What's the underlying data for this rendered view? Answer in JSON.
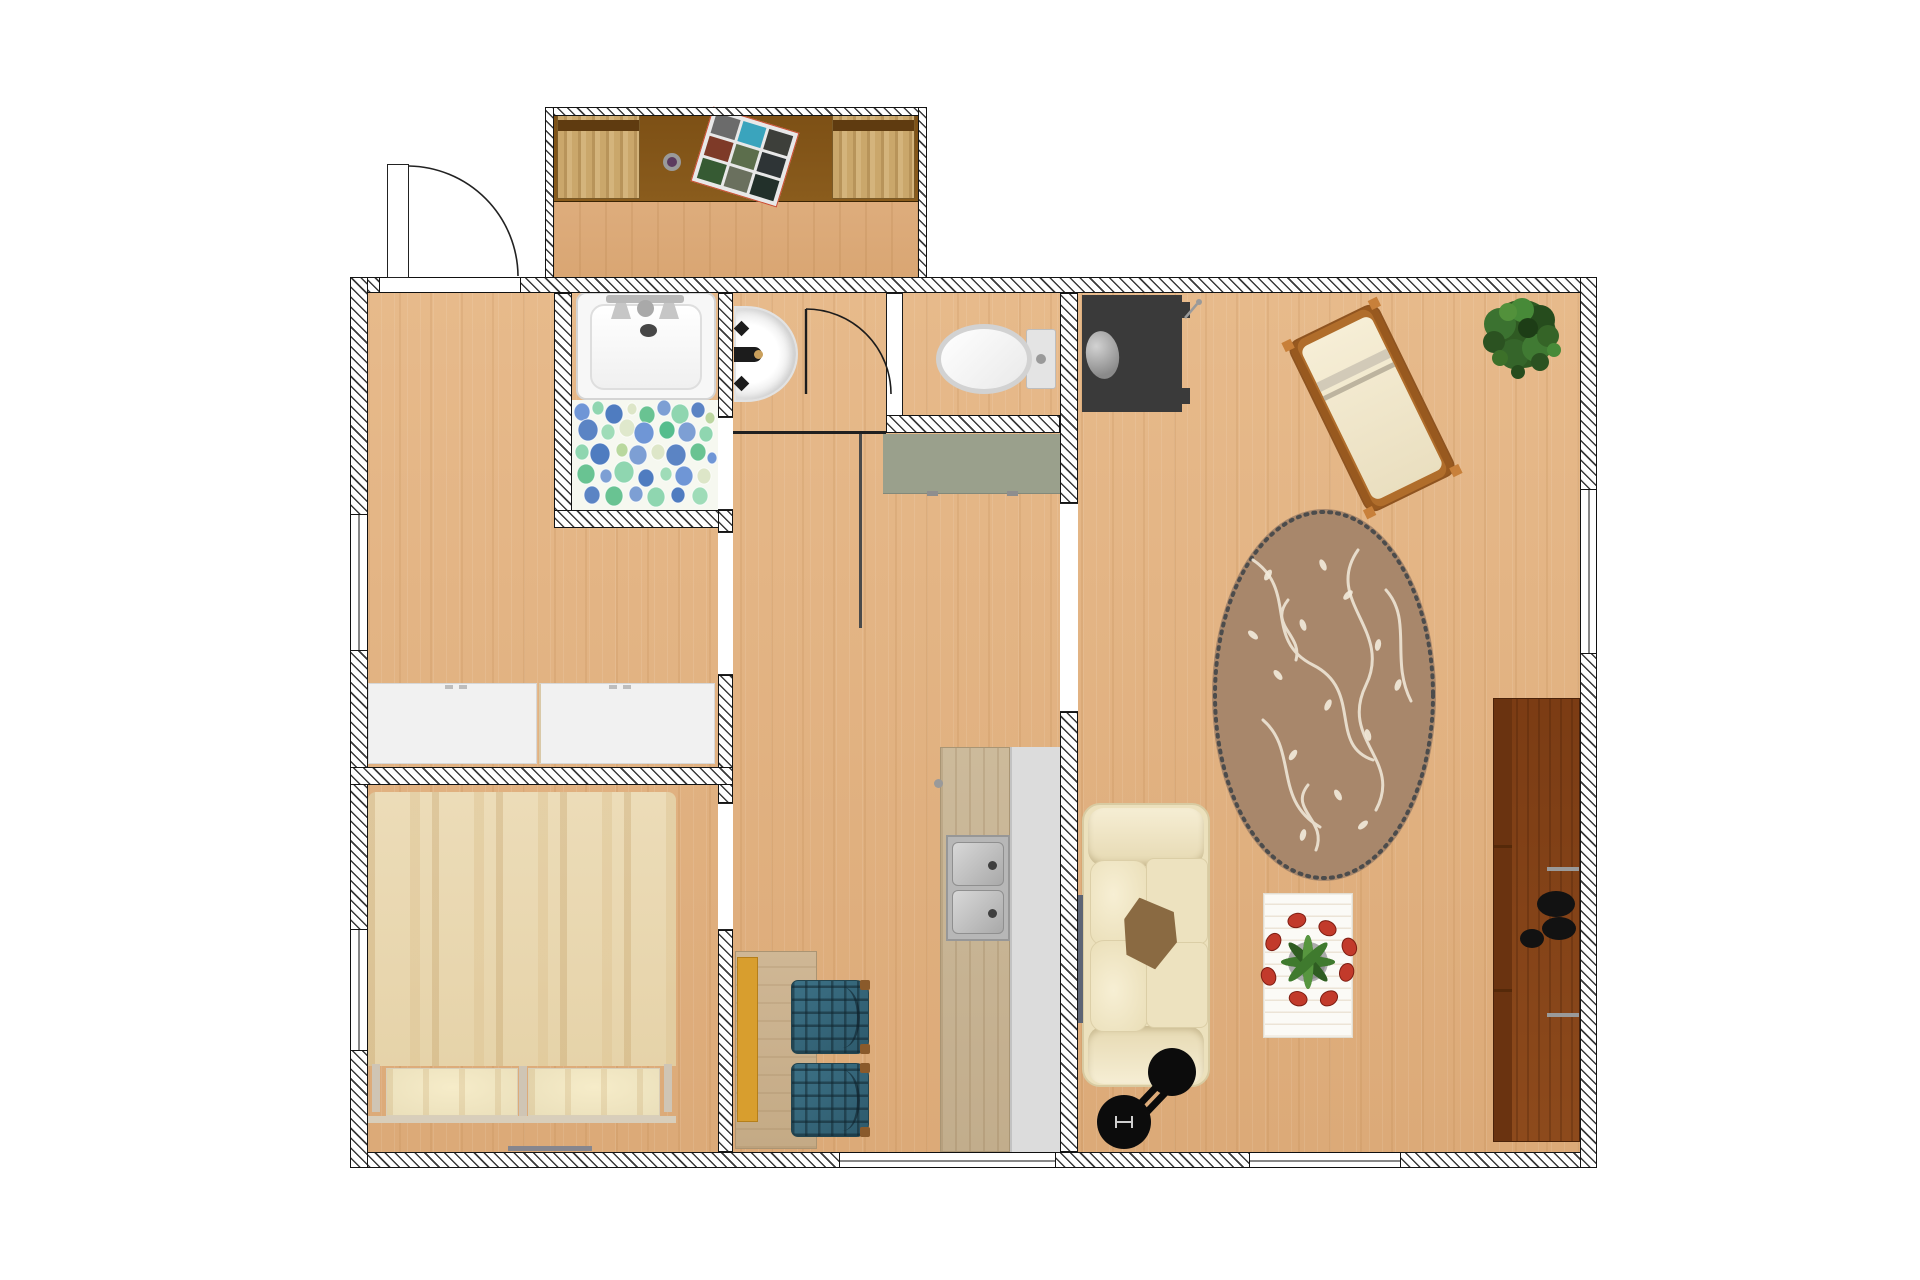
{
  "app": {
    "type": "floor-plan-render",
    "background": "#ffffff",
    "canvas_w": 1920,
    "canvas_h": 1280
  },
  "palette": {
    "floor_wood": "#e4b283",
    "wall_hatch": "#3a3a3a",
    "wall_outline": "#141414",
    "mosaic_bg": "#f6f8f0",
    "mosaic_blue": "#5b84c4",
    "mosaic_green": "#69c392",
    "rug_base": "#a8876b",
    "rug_pattern": "#f3ebdc",
    "rug_border": "#4c4c4c",
    "sofa_cream": "#ece1bd",
    "chair_plaid": "#2e5a6c",
    "bench_yellow": "#d89e2e",
    "counter_gray_green": "#9aa08c",
    "counter_white": "#dcdcdc",
    "counter_wood": "#c9b697",
    "tv_dark": "#3a3a3a",
    "sideboard_brown": "#7b3c14",
    "chaise_frame": "#b06d2b",
    "plant_green": "#2f5a23",
    "tulip_red": "#c23a2b",
    "bed_duvet": "#ead9b4",
    "desk_brown": "#7d5015",
    "fixture_white": "#f7f7f7"
  },
  "rooms": [
    {
      "id": "balcony",
      "label": "balcony",
      "rect": [
        545,
        107,
        382,
        186
      ]
    },
    {
      "id": "hallway",
      "label": "hallway-closet-room",
      "rect": [
        368,
        293,
        350,
        474
      ]
    },
    {
      "id": "bathroom",
      "label": "bathroom",
      "rect": [
        572,
        293,
        146,
        217
      ]
    },
    {
      "id": "washroom",
      "label": "washbasin-room",
      "rect": [
        733,
        293,
        153,
        138
      ]
    },
    {
      "id": "wc",
      "label": "toilet-room",
      "rect": [
        903,
        293,
        157,
        122
      ]
    },
    {
      "id": "bedroom",
      "label": "bedroom",
      "rect": [
        368,
        785,
        350,
        367
      ]
    },
    {
      "id": "kitchen",
      "label": "kitchen-dining",
      "rect": [
        733,
        433,
        327,
        719
      ]
    },
    {
      "id": "living",
      "label": "living-room",
      "rect": [
        1078,
        293,
        502,
        859
      ]
    }
  ],
  "openings": {
    "entry_door": {
      "rect": [
        380,
        277,
        140,
        16
      ],
      "swing": "out-north",
      "hinge": "left"
    },
    "washroom_door": {
      "leaf_x": 806,
      "leaf_y1": 309,
      "leaf_y2": 394,
      "arc_end": [
        891,
        389
      ]
    },
    "doorway_bath": {
      "rect": [
        718,
        417,
        15,
        93
      ]
    },
    "doorway_hall_kitchen": {
      "rect": [
        718,
        532,
        15,
        143
      ]
    },
    "doorway_bedroom": {
      "rect": [
        718,
        803,
        15,
        127
      ]
    },
    "doorway_living": {
      "rect": [
        1060,
        503,
        18,
        209
      ]
    },
    "window_left_upper": {
      "rect": [
        350,
        515,
        18,
        135
      ]
    },
    "window_left_lower": {
      "rect": [
        350,
        930,
        18,
        120
      ]
    },
    "window_right": {
      "rect": [
        1580,
        490,
        17,
        163
      ]
    },
    "window_bottom_kitchen": {
      "rect": [
        840,
        1152,
        215,
        16
      ]
    },
    "window_bottom_living": {
      "rect": [
        1250,
        1152,
        150,
        16
      ]
    }
  },
  "furniture": [
    {
      "name": "balcony-desk",
      "room": "balcony",
      "rect": [
        553,
        114,
        366,
        88
      ],
      "color": "#7d5015"
    },
    {
      "name": "balcony-chair-left",
      "room": "balcony",
      "rect": [
        557,
        114,
        83,
        85
      ],
      "color": "#c5a267"
    },
    {
      "name": "balcony-chair-right",
      "room": "balcony",
      "rect": [
        832,
        114,
        83,
        85
      ],
      "color": "#c5a267"
    },
    {
      "name": "photo-collage",
      "room": "balcony",
      "rect": [
        700,
        118,
        90,
        78
      ],
      "rotation": 17
    },
    {
      "name": "decorative-bowl",
      "room": "balcony",
      "center": [
        672,
        162
      ],
      "r": 9,
      "color": "#5c3b5e"
    },
    {
      "name": "bathtub",
      "room": "bathroom",
      "rect": [
        576,
        292,
        140,
        108
      ],
      "color": "#f7f7f7"
    },
    {
      "name": "mosaic-floor",
      "room": "bathroom",
      "rect": [
        572,
        400,
        146,
        110
      ]
    },
    {
      "name": "washbasin",
      "room": "washroom",
      "rect": [
        734,
        306,
        64,
        96
      ],
      "color": "#ffffff"
    },
    {
      "name": "toilet",
      "room": "wc",
      "rect": [
        938,
        326,
        118,
        66
      ],
      "color": "#ececec"
    },
    {
      "name": "closet-left",
      "room": "hallway",
      "rect": [
        368,
        683,
        169,
        81
      ],
      "color": "#f1f1f1"
    },
    {
      "name": "closet-right",
      "room": "hallway",
      "rect": [
        539,
        683,
        176,
        81
      ],
      "color": "#f1f1f1"
    },
    {
      "name": "upper-counter",
      "room": "kitchen",
      "rect": [
        883,
        434,
        177,
        60
      ],
      "color": "#9aa08c"
    },
    {
      "name": "counter-wood",
      "room": "kitchen",
      "rect": [
        940,
        747,
        70,
        405
      ],
      "color": "#c9b697"
    },
    {
      "name": "counter-white",
      "room": "kitchen",
      "rect": [
        1010,
        747,
        50,
        405
      ],
      "color": "#dcdcdc"
    },
    {
      "name": "kitchen-sink",
      "room": "kitchen",
      "rect": [
        946,
        835,
        64,
        106
      ],
      "basins": 2
    },
    {
      "name": "dining-table",
      "room": "kitchen",
      "rect": [
        735,
        951,
        82,
        198
      ],
      "color": "#cdb48f"
    },
    {
      "name": "dining-bench",
      "room": "kitchen",
      "rect": [
        737,
        957,
        21,
        165
      ],
      "color": "#d89e2e"
    },
    {
      "name": "dining-chair-1",
      "room": "kitchen",
      "rect": [
        791,
        980,
        78,
        74
      ],
      "color": "#2e5a6c"
    },
    {
      "name": "dining-chair-2",
      "room": "kitchen",
      "rect": [
        791,
        1063,
        78,
        74
      ],
      "color": "#2e5a6c"
    },
    {
      "name": "double-bed",
      "room": "bedroom",
      "rect": [
        368,
        792,
        308,
        331
      ],
      "color": "#ead9b4"
    },
    {
      "name": "bed-pillow-left",
      "room": "bedroom",
      "rect": [
        386,
        1068,
        132,
        48
      ]
    },
    {
      "name": "bed-pillow-right",
      "room": "bedroom",
      "rect": [
        528,
        1068,
        132,
        48
      ]
    },
    {
      "name": "floor-mat",
      "room": "bedroom",
      "rect": [
        508,
        1146,
        84,
        5
      ],
      "color": "#86868e"
    },
    {
      "name": "tv-set",
      "room": "living",
      "rect": [
        1082,
        295,
        100,
        117
      ],
      "color": "#3a3a3a"
    },
    {
      "name": "lounge-chair",
      "room": "living",
      "rect": [
        1322,
        313,
        100,
        190
      ],
      "rotation": -26,
      "color": "#b06d2b"
    },
    {
      "name": "potted-plant",
      "room": "living",
      "center": [
        1522,
        336
      ],
      "r": 52,
      "color": "#2f5a23"
    },
    {
      "name": "area-rug",
      "room": "living",
      "rect": [
        1208,
        505,
        232,
        380
      ],
      "color": "#a8876b"
    },
    {
      "name": "sofa",
      "room": "living",
      "rect": [
        1082,
        803,
        128,
        284
      ],
      "color": "#ece1bd"
    },
    {
      "name": "throw-blanket",
      "room": "living",
      "rect": [
        1120,
        898,
        56,
        68
      ],
      "color": "#8a6a42"
    },
    {
      "name": "fitness-roller",
      "room": "living",
      "rect": [
        1080,
        1028,
        130,
        130
      ],
      "color": "#0c0c0c"
    },
    {
      "name": "coffee-table",
      "room": "living",
      "rect": [
        1263,
        893,
        90,
        145
      ],
      "color": "#fbfaf6"
    },
    {
      "name": "tulip-centerpiece",
      "room": "living",
      "center": [
        1308,
        962
      ]
    },
    {
      "name": "sideboard",
      "room": "living",
      "rect": [
        1493,
        698,
        87,
        444
      ],
      "color": "#7b3c14"
    },
    {
      "name": "coffee-cups",
      "room": "living",
      "count": 3,
      "color": "#121212"
    },
    {
      "name": "radiator",
      "room": "living",
      "rect": [
        1078,
        895,
        5,
        128
      ],
      "color": "#5c6474"
    }
  ]
}
